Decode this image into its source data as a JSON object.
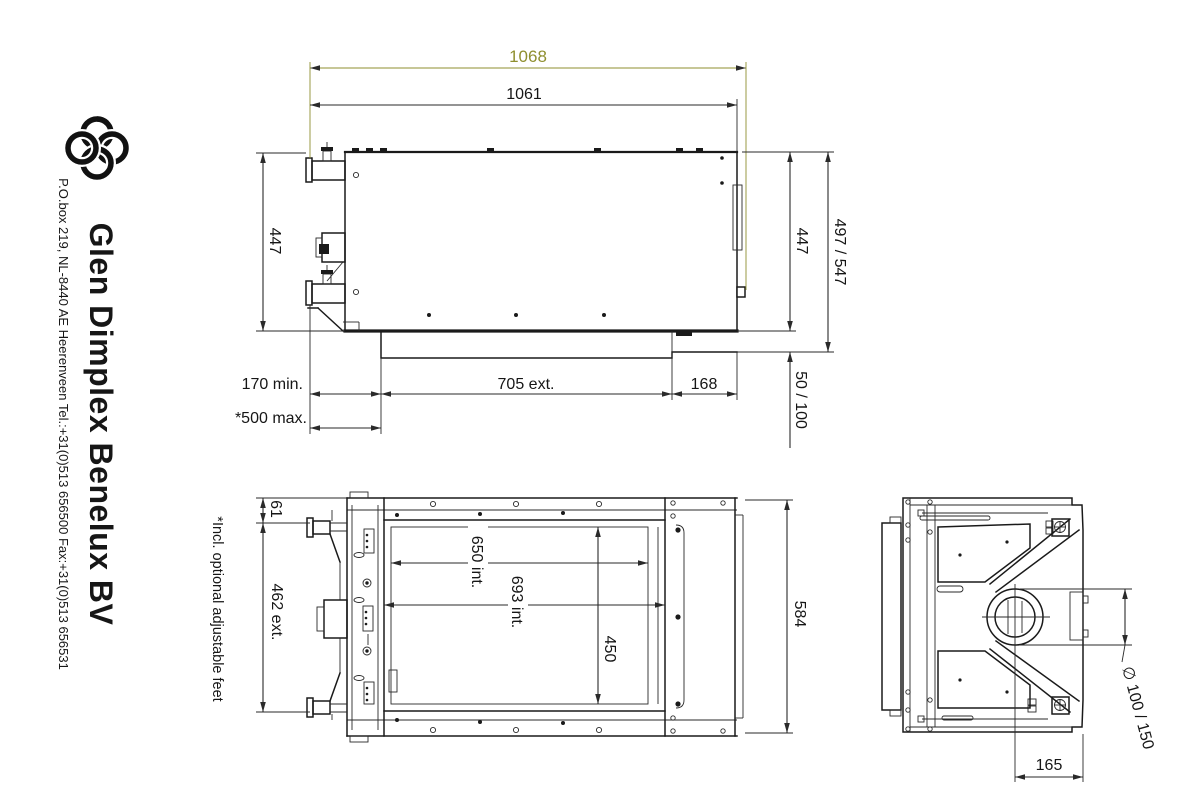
{
  "company": {
    "name": "Glen Dimplex Benelux BV",
    "address": "P.O.box 219, NL-8440 AE Heerenveen Tel.:+31(0)513 656500  Fax:+31(0)513 656531"
  },
  "note": "*Incl. optional adjustable feet",
  "colors": {
    "line": "#1a1a1a",
    "highlight": "#8f8f2f",
    "background": "#ffffff"
  },
  "top_view": {
    "width_overall": "1068",
    "width_body": "1061",
    "depth_left": "447",
    "depth_right": "447",
    "depth_total": "497 / 547",
    "flue_depth": "50 / 100",
    "clearance_min": "170 min.",
    "clearance_max": "*500 max.",
    "extension_width": "705 ext.",
    "offset_right": "168"
  },
  "front_view": {
    "top_margin": "61",
    "height_ext": "462 ext.",
    "width_inner_a": "650 int.",
    "width_inner_b": "693 int.",
    "height_inner": "450",
    "height_overall": "584"
  },
  "side_view": {
    "flue_diameter": "∅ 100 / 150",
    "flue_offset": "165"
  }
}
